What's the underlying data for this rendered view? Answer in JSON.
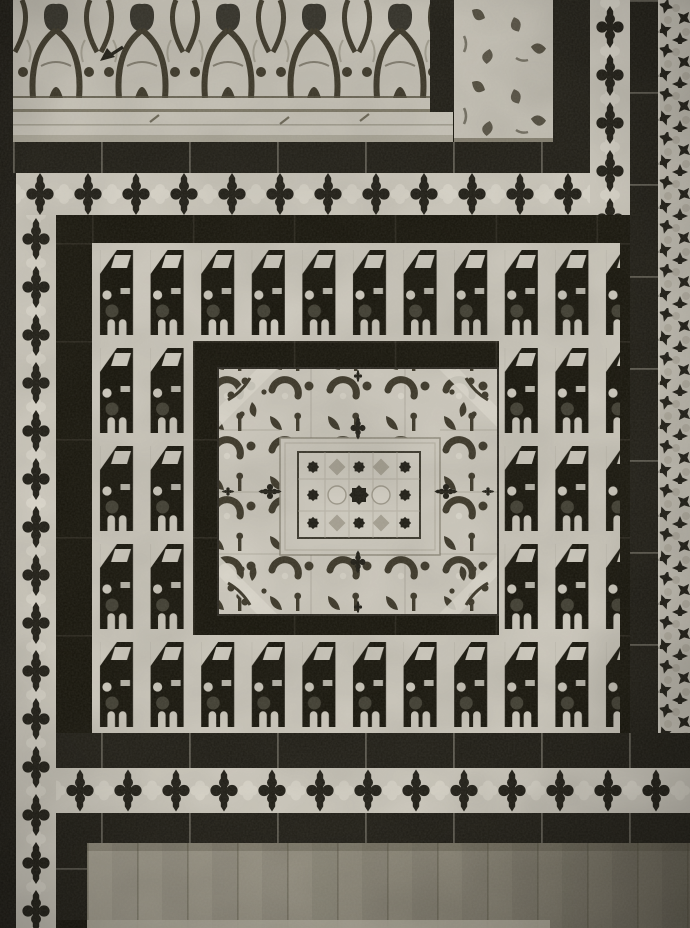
{
  "meta": {
    "type": "black-and-white photograph",
    "subject": "Moorish zellige tile dado panel with carved stucco frieze",
    "aria_label": "Black-and-white photograph of a Moorish zellige tile panel: carved stucco arabesque frieze above, tiled dado framed by bands of dark four-lobed crosses on light ground, a field of dark Kufic-style glyph tiles surrounding a central arabesque medallion with an eight-pointed star lattice, a vertical star-mosaic strip on the right edge, and a plain plaster dado with vertical joints below."
  },
  "palette": {
    "paperBlack": "#14120d",
    "ink": "#1d1b14",
    "ink2": "#141209",
    "light": "#cfcbc0",
    "light2": "#dcd8cd",
    "stucco": "#c6c2b7",
    "sink": "#3b3628",
    "mid": "#a7a294",
    "dado1": "#a8a394",
    "dado2": "#6e695b"
  },
  "composition": {
    "frieze": {
      "kind": "carved stucco arabesque band",
      "position": "top",
      "arch_units": 5
    },
    "annotation": {
      "kind": "small dark arrow mark drawn on the frieze",
      "points": "left"
    },
    "molding": {
      "kind": "plain stucco molding with horizontal shadow seam"
    },
    "pilaster": {
      "kind": "carved stucco panel at top right flanked by dark bands"
    },
    "borders": {
      "cross_band_crosses_top": 12,
      "cross_band_crosses_bottom": 13,
      "cross_strip_crosses_left": 14,
      "cross_strip_crosses_right": 5,
      "motif": "dark four-lobed cross with pointed vertical tips on light ground"
    },
    "field": {
      "motif": "dark tower-shaped Kufic-style glyph tiles on light ground",
      "rows": 5,
      "glyphs_top_row": 10,
      "glyphs_bottom_row": 10,
      "side_rows_each": 3
    },
    "medallion": {
      "border": "arabesque scroll band with corner diagonals and mid-side fleur crosses",
      "frame": "plain light bevelled frame",
      "center": "checkered star lattice with central eight-pointed dark star"
    },
    "right_strip": {
      "kind": "vertical star-mosaic band of small dark four-point stars"
    },
    "dado": {
      "kind": "plain plaster dado with vertical joints, darker toward right"
    }
  }
}
